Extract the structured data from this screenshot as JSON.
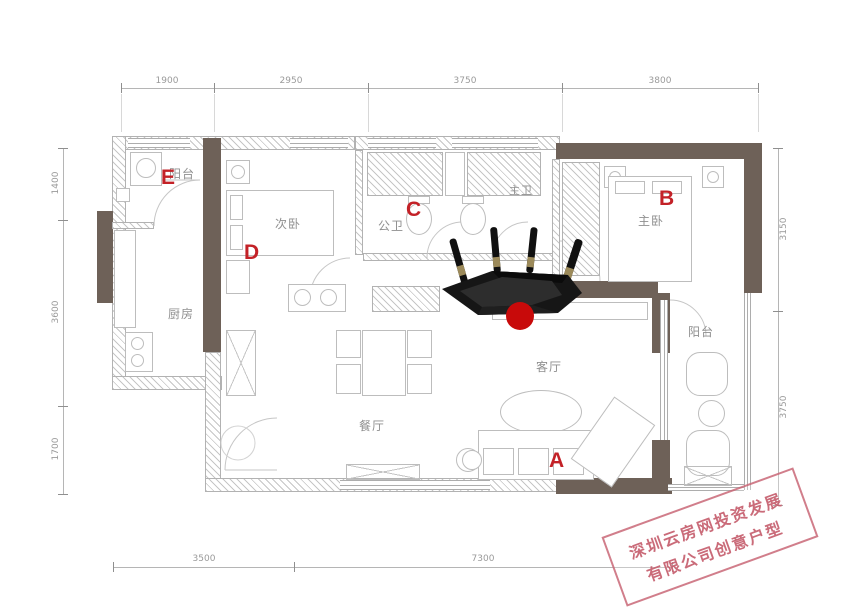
{
  "floorplan": {
    "rooms": {
      "balcony_top": "阳台",
      "second_bedroom": "次卧",
      "guest_bath": "公卫",
      "master_bath": "主卫",
      "master_bedroom": "主卧",
      "kitchen": "厨房",
      "dining": "餐厅",
      "living": "客厅",
      "balcony_right": "阳台"
    },
    "markers": {
      "a": "A",
      "b": "B",
      "c": "C",
      "d": "D",
      "e": "E"
    },
    "dimensions": {
      "top": [
        "1900",
        "2950",
        "3750",
        "3800"
      ],
      "bottom": [
        "3500",
        "7300"
      ],
      "left": [
        "1400",
        "3600",
        "1700"
      ],
      "right": [
        "3150",
        "3750"
      ]
    },
    "watermark": {
      "line1": "深圳云房网投资发展",
      "line2": "有限公司创意户型"
    },
    "colors": {
      "marker_red": "#c32127",
      "dot_red": "#c80a0a",
      "wall_dark": "#6e6158",
      "watermark_rose": "#c55e6e"
    }
  }
}
